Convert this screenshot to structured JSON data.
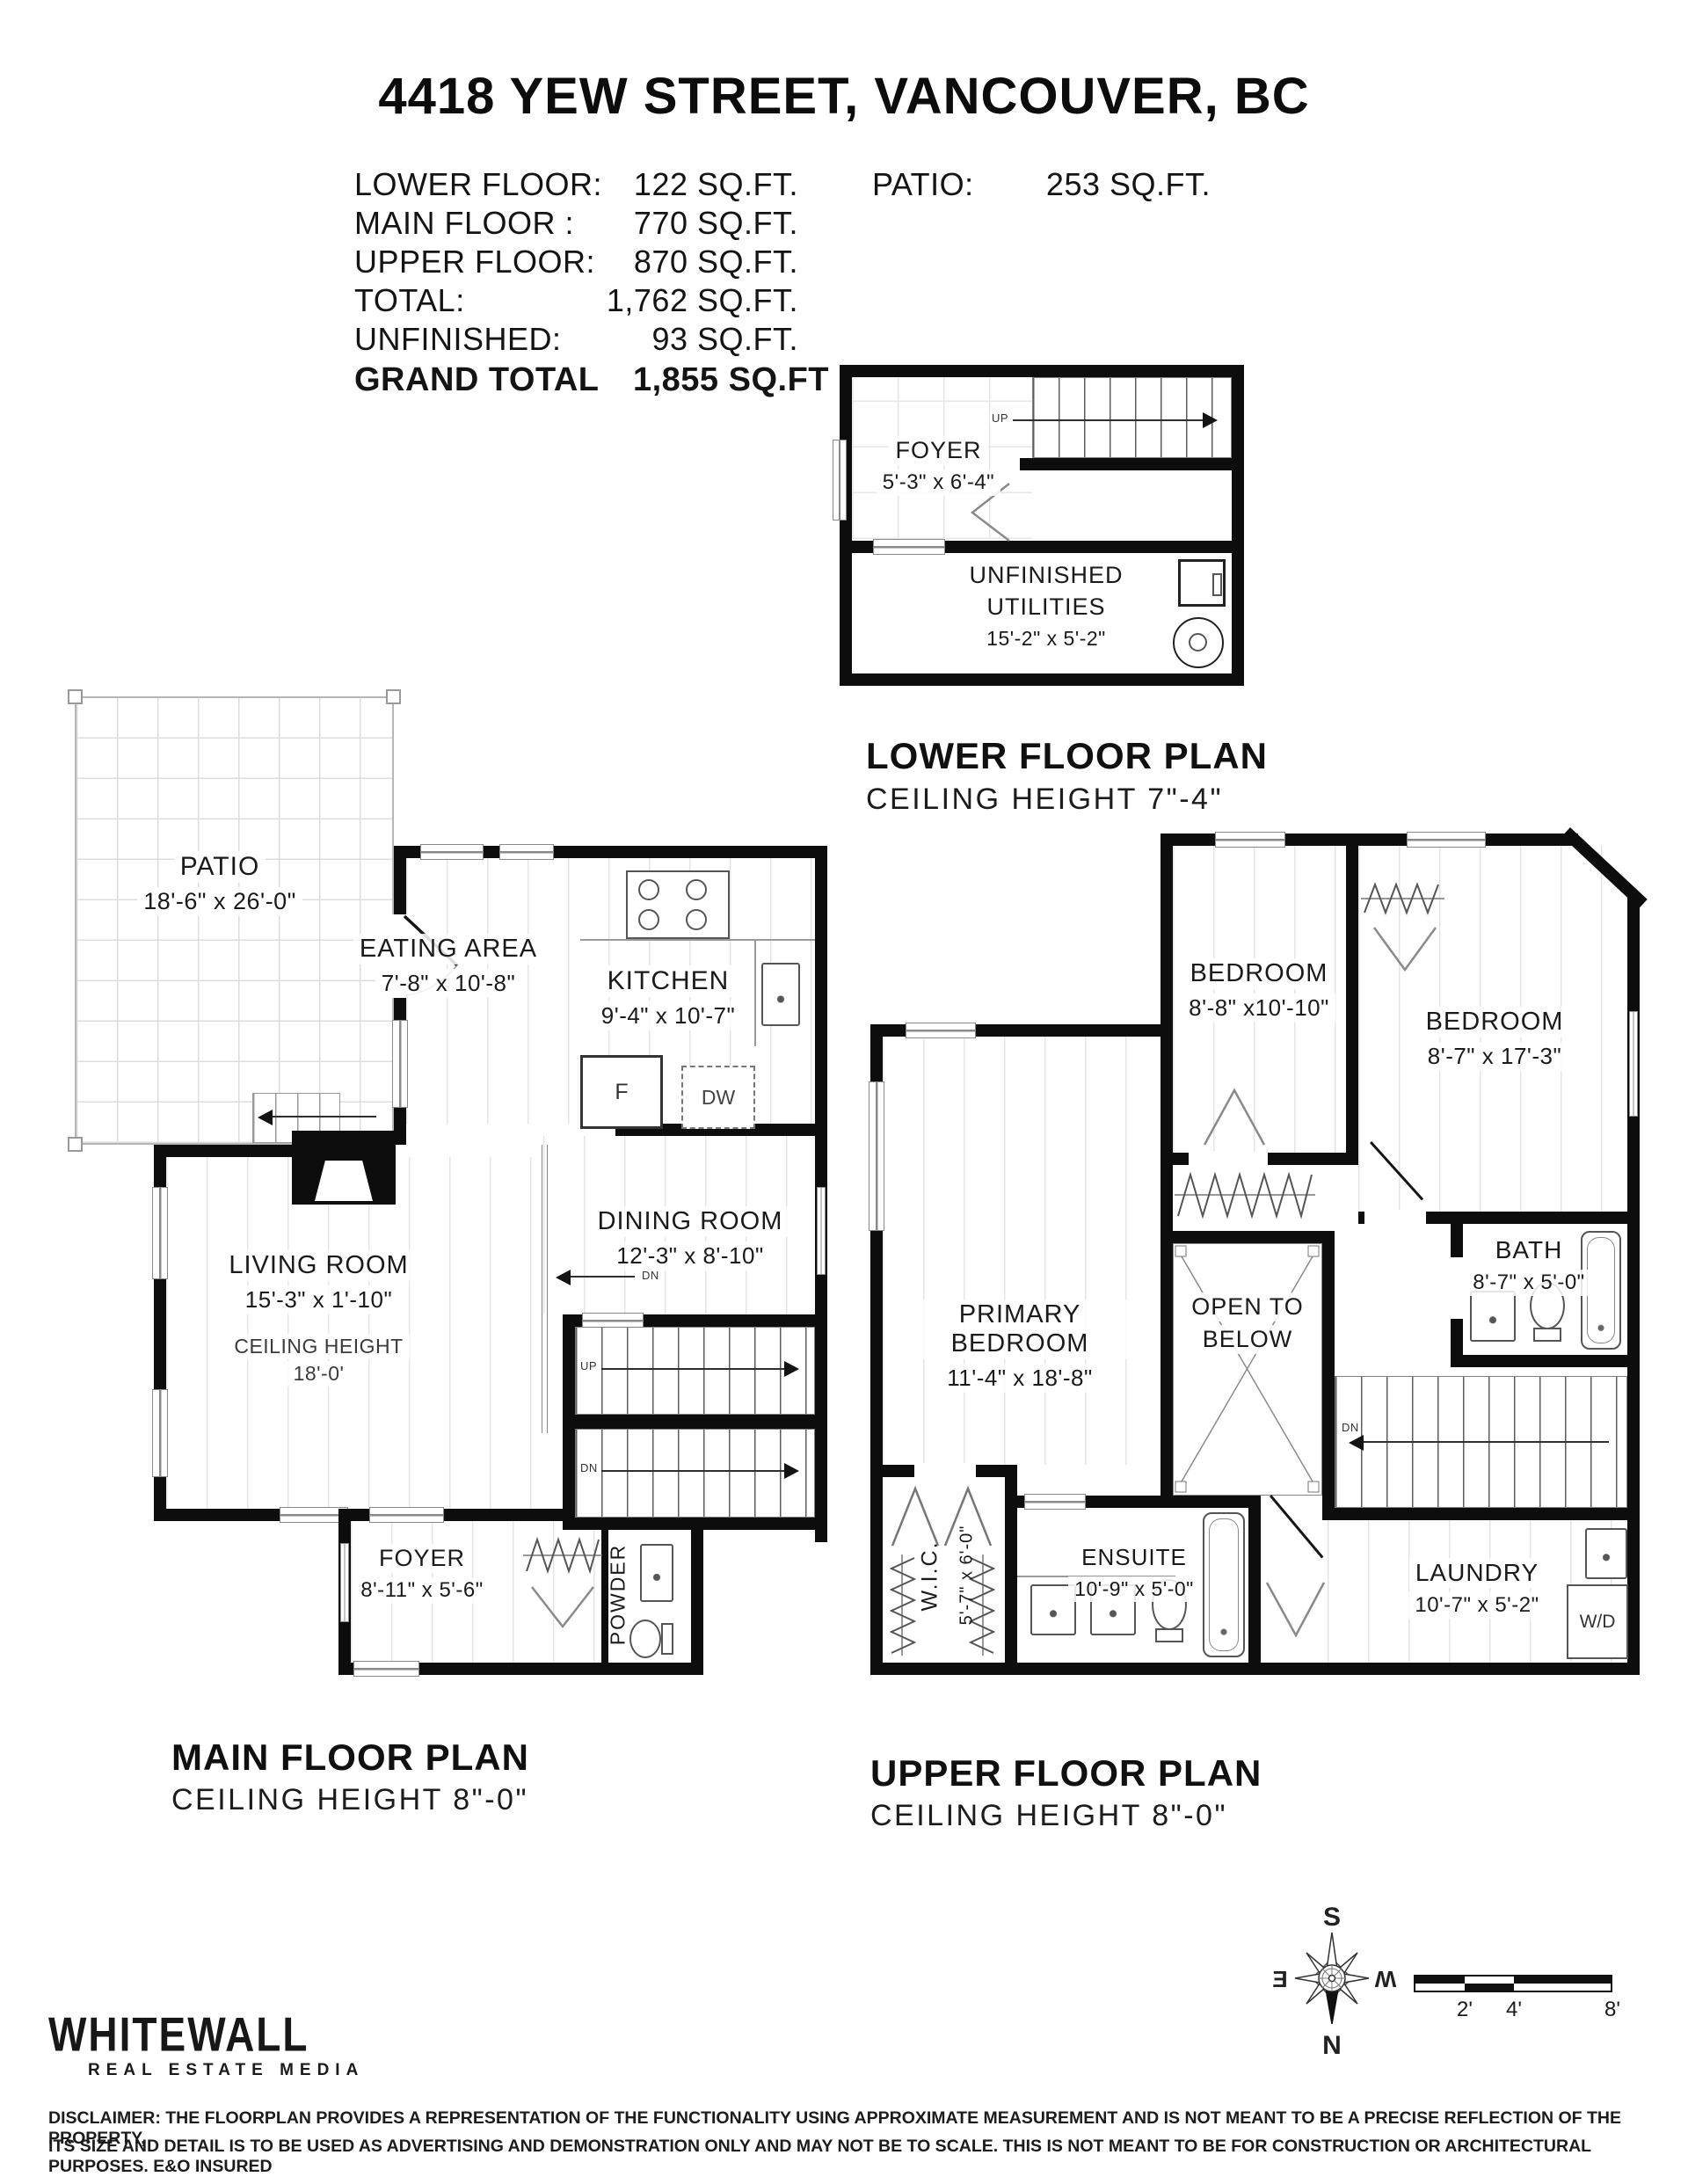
{
  "title": "4418 YEW STREET, VANCOUVER, BC",
  "stats": {
    "rows": [
      {
        "label": "LOWER FLOOR:",
        "value": "122 SQ.FT."
      },
      {
        "label": "MAIN FLOOR :",
        "value": "770 SQ.FT."
      },
      {
        "label": "UPPER FLOOR:",
        "value": "870 SQ.FT."
      },
      {
        "label": "TOTAL:",
        "value": "1,762 SQ.FT."
      },
      {
        "label": "UNFINISHED:",
        "value": "93 SQ.FT."
      }
    ],
    "grand_label": "GRAND TOTAL",
    "grand_value": "1,855 SQ.FT",
    "patio_label": "PATIO:",
    "patio_value": "253 SQ.FT."
  },
  "lower": {
    "plan_title": "LOWER FLOOR PLAN",
    "plan_subtitle": "CEILING HEIGHT 7\"-4\"",
    "foyer_name": "FOYER",
    "foyer_dims": "5'-3\" x 6'-4\"",
    "util_line1": "UNFINISHED",
    "util_line2": "UTILITIES",
    "util_dims": "15'-2\" x 5'-2\"",
    "up": "UP"
  },
  "main": {
    "plan_title": "MAIN FLOOR PLAN",
    "plan_subtitle": "CEILING HEIGHT 8\"-0\"",
    "patio_name": "PATIO",
    "patio_dims": "18'-6\" x 26'-0\"",
    "eating_name": "EATING AREA",
    "eating_dims": "7'-8\" x 10'-8\"",
    "kitchen_name": "KITCHEN",
    "kitchen_dims": "9'-4\" x 10'-7\"",
    "living_name": "LIVING ROOM",
    "living_dims": "15'-3\" x 1'-10\"",
    "living_ch1": "CEILING HEIGHT",
    "living_ch2": "18'-0'",
    "dining_name": "DINING ROOM",
    "dining_dims": "12'-3\" x 8'-10\"",
    "foyer_name": "FOYER",
    "foyer_dims": "8'-11\" x 5'-6\"",
    "powder_name": "POWDER",
    "fridge": "F",
    "dw": "DW",
    "up": "UP",
    "dn": "DN"
  },
  "upper": {
    "plan_title": "UPPER FLOOR PLAN",
    "plan_subtitle": "CEILING HEIGHT 8\"-0\"",
    "bed1_name": "BEDROOM",
    "bed1_dims": "8'-8\" x10'-10\"",
    "bed2_name": "BEDROOM",
    "bed2_dims": "8'-7\" x 17'-3\"",
    "bath_name": "BATH",
    "bath_dims": "8'-7\" x 5'-0\"",
    "primary_name": "PRIMARY BEDROOM",
    "primary_dims": "11'-4\" x 18'-8\"",
    "open1": "OPEN TO",
    "open2": "BELOW",
    "wic_name": "W.I.C.",
    "wic_dims": "5'-7\" x 6'-0\"",
    "ensuite_name": "ENSUITE",
    "ensuite_dims": "10'-9\" x 5'-0\"",
    "laundry_name": "LAUNDRY",
    "laundry_dims": "10'-7\" x 5'-2\"",
    "wd": "W/D",
    "dn": "DN"
  },
  "footer": {
    "logo1": "WHITEWALL",
    "logo2": "REAL ESTATE MEDIA",
    "disc1": "DISCLAIMER: THE FLOORPLAN PROVIDES A REPRESENTATION OF THE FUNCTIONALITY USING APPROXIMATE MEASUREMENT AND IS NOT MEANT TO BE A PRECISE REFLECTION OF THE PROPERTY,",
    "disc2": "ITS SIZE AND DETAIL IS TO BE USED AS ADVERTISING AND DEMONSTRATION ONLY AND MAY NOT BE TO SCALE. THIS IS NOT MEANT TO BE FOR CONSTRUCTION OR ARCHITECTURAL PURPOSES. E&O INSURED"
  },
  "compass": {
    "n": "N",
    "s": "S",
    "e": "E",
    "w": "W"
  },
  "scale": {
    "ticks": [
      "2'",
      "4'",
      "8'"
    ]
  }
}
